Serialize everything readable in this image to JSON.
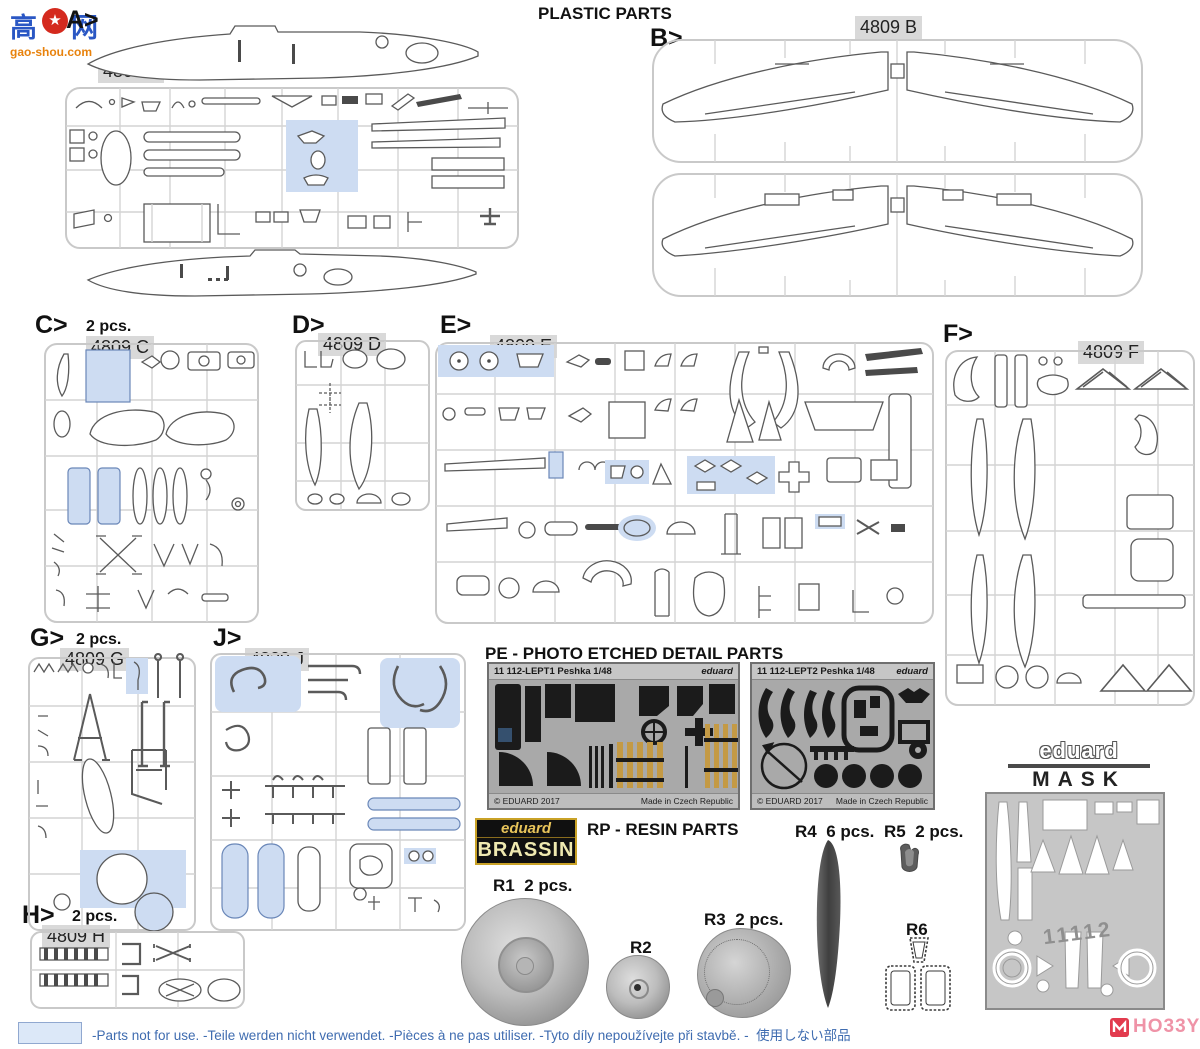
{
  "page": {
    "title": "PLASTIC PARTS"
  },
  "watermark": {
    "char_left": "高",
    "char_right": "网",
    "site": "gao-shou.com"
  },
  "sprues": {
    "A": {
      "tag": "A>",
      "code": "4809 A"
    },
    "B": {
      "tag": "B>",
      "code": "4809 B"
    },
    "C": {
      "tag": "C>",
      "qty": "2 pcs.",
      "code": "4809 C"
    },
    "D": {
      "tag": "D>",
      "code": "4809 D"
    },
    "E": {
      "tag": "E>",
      "code": "4809 E"
    },
    "F": {
      "tag": "F>",
      "code": "4809 F"
    },
    "G": {
      "tag": "G>",
      "qty": "2 pcs.",
      "code": "4809 G"
    },
    "J": {
      "tag": "J>",
      "code": "4809 J"
    },
    "H": {
      "tag": "H>",
      "qty": "2 pcs.",
      "code": "4809 H"
    }
  },
  "pe": {
    "title": "PE - PHOTO ETCHED DETAIL PARTS",
    "frets": [
      {
        "header": "11 112-LEPT1 Peshka 1/48",
        "brand": "eduard",
        "copyright": "© EDUARD 2017",
        "origin": "Made in Czech Republic"
      },
      {
        "header": "11 112-LEPT2 Peshka 1/48",
        "brand": "eduard",
        "copyright": "© EDUARD 2017",
        "origin": "Made in Czech Republic"
      }
    ]
  },
  "resin": {
    "title": "RP - RESIN PARTS",
    "brassin": {
      "brand": "eduard",
      "line": "BRASSIN"
    },
    "parts": [
      {
        "id": "R1",
        "qty": "2 pcs."
      },
      {
        "id": "R2",
        "qty": ""
      },
      {
        "id": "R3",
        "qty": "2 pcs."
      },
      {
        "id": "R4",
        "qty": "6 pcs."
      },
      {
        "id": "R5",
        "qty": "2 pcs."
      },
      {
        "id": "R6",
        "qty": ""
      }
    ]
  },
  "mask": {
    "brand": "eduard",
    "label": "MASK",
    "sheet_number": "11112"
  },
  "legend": {
    "text": "-Parts not for use. -Teile werden nicht verwendet. -Pièces à ne pas utiliser. -Tyto díly nepoužívejte při stavbě. -",
    "text_jp": "使用しない部品"
  },
  "footer_logo": {
    "text1": "HO33Y",
    "text2": "SEARCH"
  },
  "colors": {
    "highlight_blue": "#cddcf2",
    "legend_blue": "#3f6cb0",
    "brassin_gold": "#c9a227",
    "hobby_pink": "#ef93a7"
  }
}
